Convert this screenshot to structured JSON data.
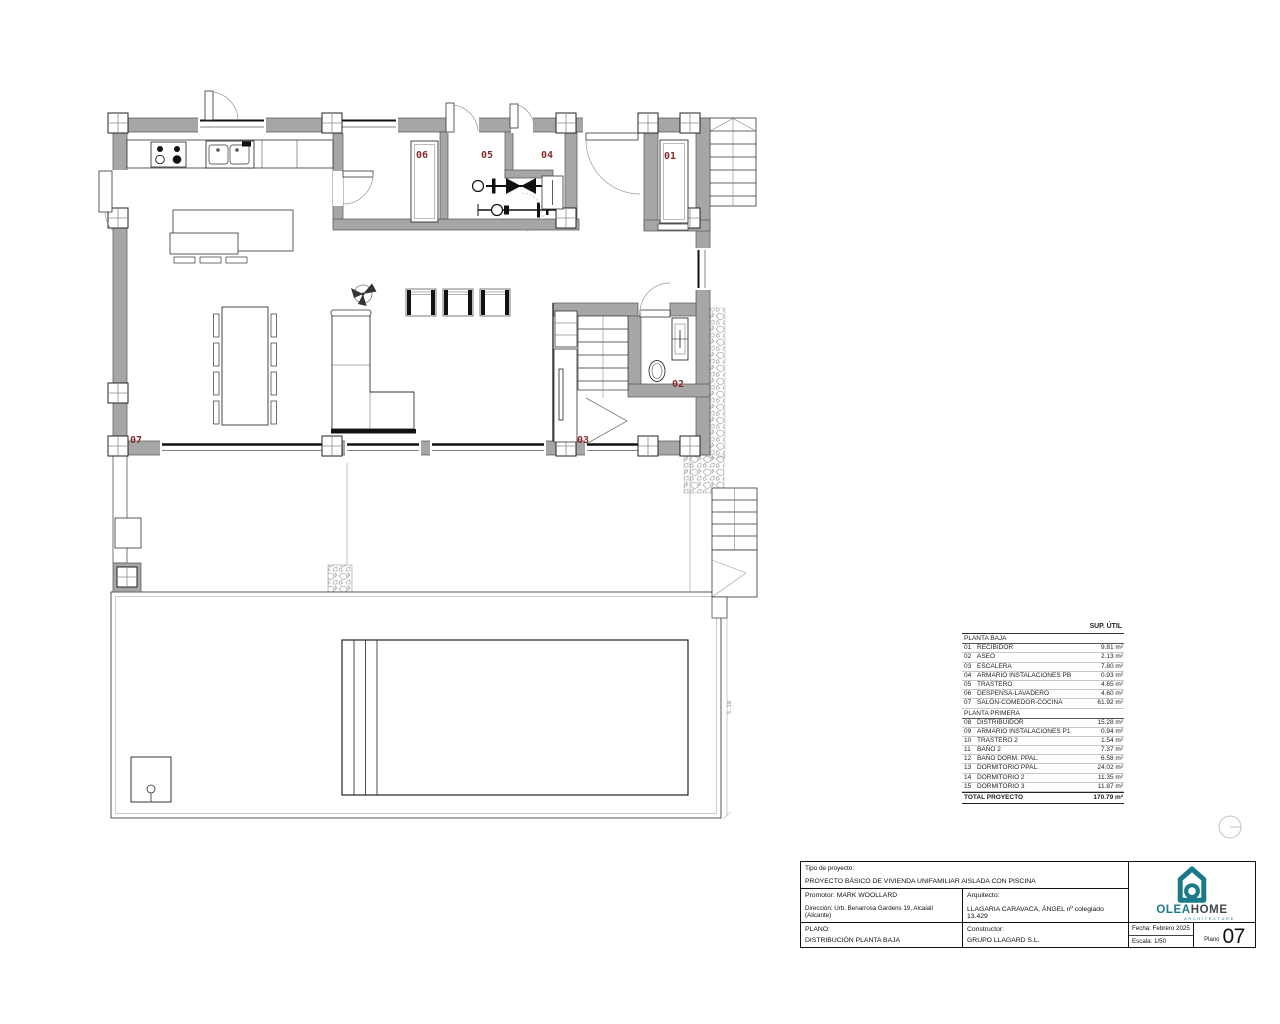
{
  "plan": {
    "labels": {
      "r01": "01",
      "r02": "02",
      "r03": "03",
      "r04": "04",
      "r05": "05",
      "r06": "06",
      "r07": "07"
    },
    "label_color": "#8a2b2b",
    "wall_color": "#a6a6a6",
    "dimension": "5.18"
  },
  "area_table": {
    "header": "SUP. ÚTIL",
    "sections": [
      {
        "title": "PLANTA BAJA",
        "rows": [
          [
            "01",
            "RECIBIDOR",
            "9.81 m²"
          ],
          [
            "02",
            "ASEO",
            "2.13 m²"
          ],
          [
            "03",
            "ESCALERA",
            "7.80 m²"
          ],
          [
            "04",
            "ARMARIO INSTALACIONES PB",
            "0.93 m²"
          ],
          [
            "05",
            "TRASTERO",
            "4.65 m²"
          ],
          [
            "06",
            "DESPENSA-LAVADERO",
            "4.60 m²"
          ],
          [
            "07",
            "SALÓN-COMEDOR-COCINA",
            "61.92 m²"
          ]
        ]
      },
      {
        "title": "PLANTA PRIMERA",
        "rows": [
          [
            "08",
            "DISTRIBUIDOR",
            "15.28 m²"
          ],
          [
            "09",
            "ARMARIO INSTALACIONES P1",
            "0.94 m²"
          ],
          [
            "10",
            "TRASTERO 2",
            "1.54 m²"
          ],
          [
            "11",
            "BAÑO 2",
            "7.37 m²"
          ],
          [
            "12",
            "BAÑO DORM. PPAL.",
            "6.58 m²"
          ],
          [
            "13",
            "DORMITORIO PPAL.",
            "24.02 m²"
          ],
          [
            "14",
            "DORMITORIO 2",
            "11.35 m²"
          ],
          [
            "15",
            "DORMITORIO 3",
            "11.87 m²"
          ]
        ]
      }
    ],
    "total_label": "TOTAL PROYECTO",
    "total_value": "170.79 m²"
  },
  "title_block": {
    "tipo_label": "Tipo de proyecto:",
    "tipo_value": "PROYECTO BÁSICO DE VIVIENDA UNIFAMILIAR AISLADA CON PISCINA",
    "promotor": "Promotor: MARK WOOLLARD",
    "direccion": "Dirección: Urb. Benarrosa Gardens 19, Alcalalí (Alicante)",
    "arquitecto_label": "Arquitecto:",
    "arquitecto_value": "LLAGARIA CARAVACA, ÁNGEL nº colegiado 13.429",
    "plano_label": "PLANO:",
    "plano_value": "DISTRIBUCIÓN PLANTA BAJA",
    "constructor_label": "Constructor:",
    "constructor_value": "GRUPO LLAGARD S.L.",
    "fecha": "Fecha: Febrero 2025",
    "escala": "Escala: 1/50",
    "sheet_label": "Plano",
    "sheet_number": "07"
  },
  "logo": {
    "part1": "OLEA",
    "part2": "HOME",
    "tagline": "ARCHITECTURE",
    "teal": "#1b7a8a",
    "dark": "#41474c"
  }
}
